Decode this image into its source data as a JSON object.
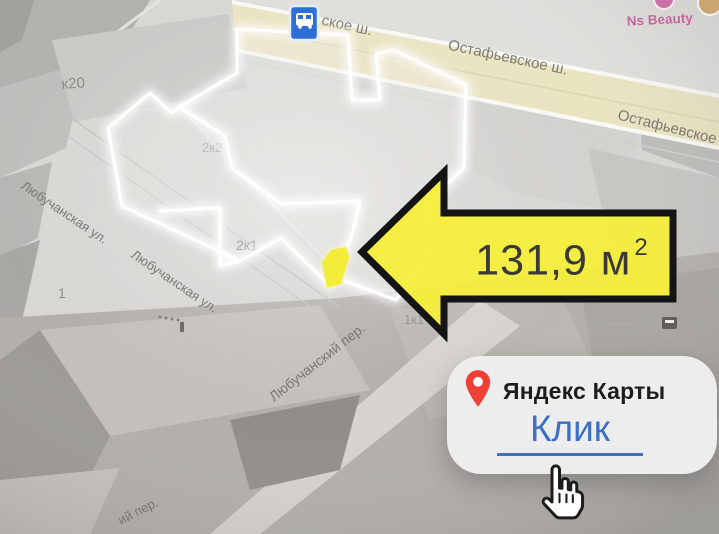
{
  "colors": {
    "arrow_yellow": "#f5ee3b",
    "glow_white": "#ffffff",
    "pin_red": "#ee4035",
    "link_blue": "#3b70c4",
    "bus_blue": "#2e6fd6",
    "poi_pink": "#c4679f"
  },
  "map": {
    "street_labels": {
      "top_partial": "ское ш.",
      "ostafyevskoe_1": "Остафьевское ш.",
      "ostafyevskoe_2": "Остафьевское ш.",
      "lyubuchanskaya_1": "Любучанская ул.",
      "lyubuchanskaya_2": "Любучанская ул.",
      "lyubuchansky_per": "Любучанский пер.",
      "per_partial": "ий пер."
    },
    "building_labels": {
      "k20": "к20",
      "b1": "1",
      "b2k2": "2к2",
      "b2k1": "2к1",
      "b1k1": "1к1"
    },
    "poi_labels": {
      "ns_beauty": "Ns Beauty"
    }
  },
  "annotation": {
    "area_value": "131,9 м",
    "area_superscript": "2"
  },
  "card": {
    "title": "Яндекс Карты",
    "link_label": "Клик"
  }
}
